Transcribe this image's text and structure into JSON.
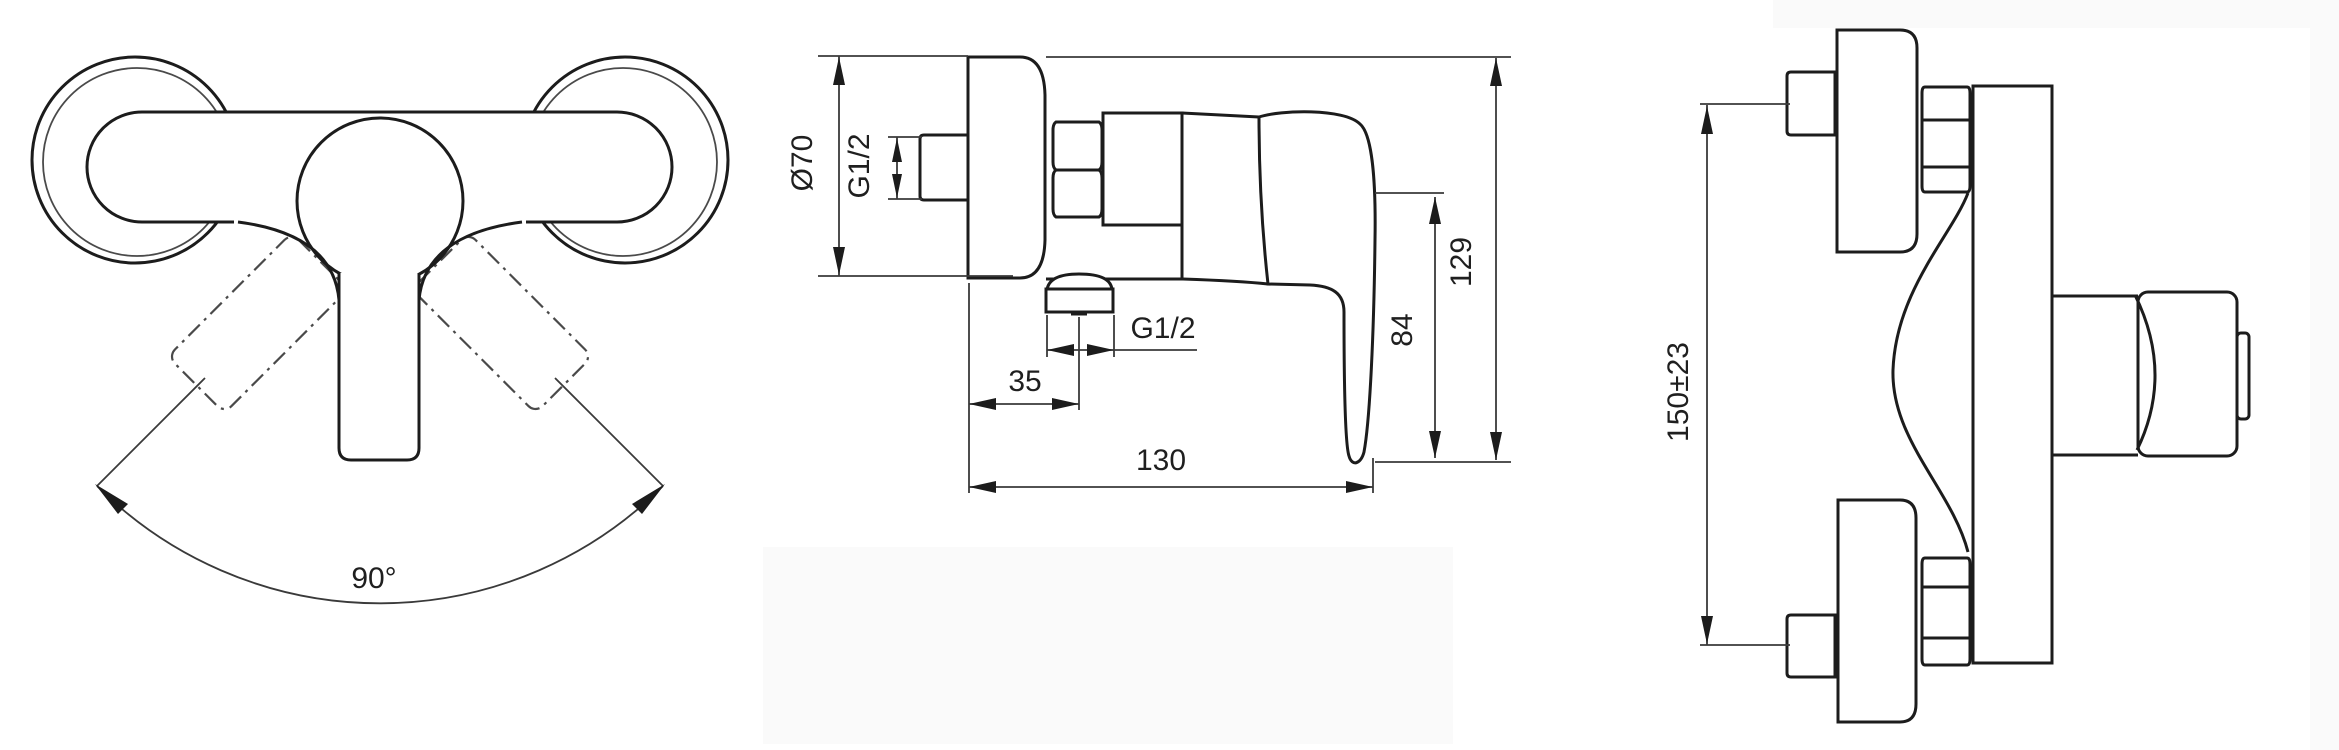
{
  "drawing": {
    "kind": "shower-mixer-technical-drawing",
    "colors": {
      "background": "#ffffff",
      "panel": "#fafafa",
      "outline": "#1c1c1c",
      "dimension": "#3a3a3a",
      "text": "#1f1f1f"
    },
    "front_view": {
      "swivel_angle": "90°"
    },
    "side_view": {
      "flange_diameter": "Ø70",
      "inlet_thread": "G1/2",
      "outlet_thread": "G1/2",
      "outlet_offset": "35",
      "total_depth": "130",
      "handle_drop": "84",
      "total_height": "129"
    },
    "top_view": {
      "mount_spacing": "150±23"
    }
  }
}
